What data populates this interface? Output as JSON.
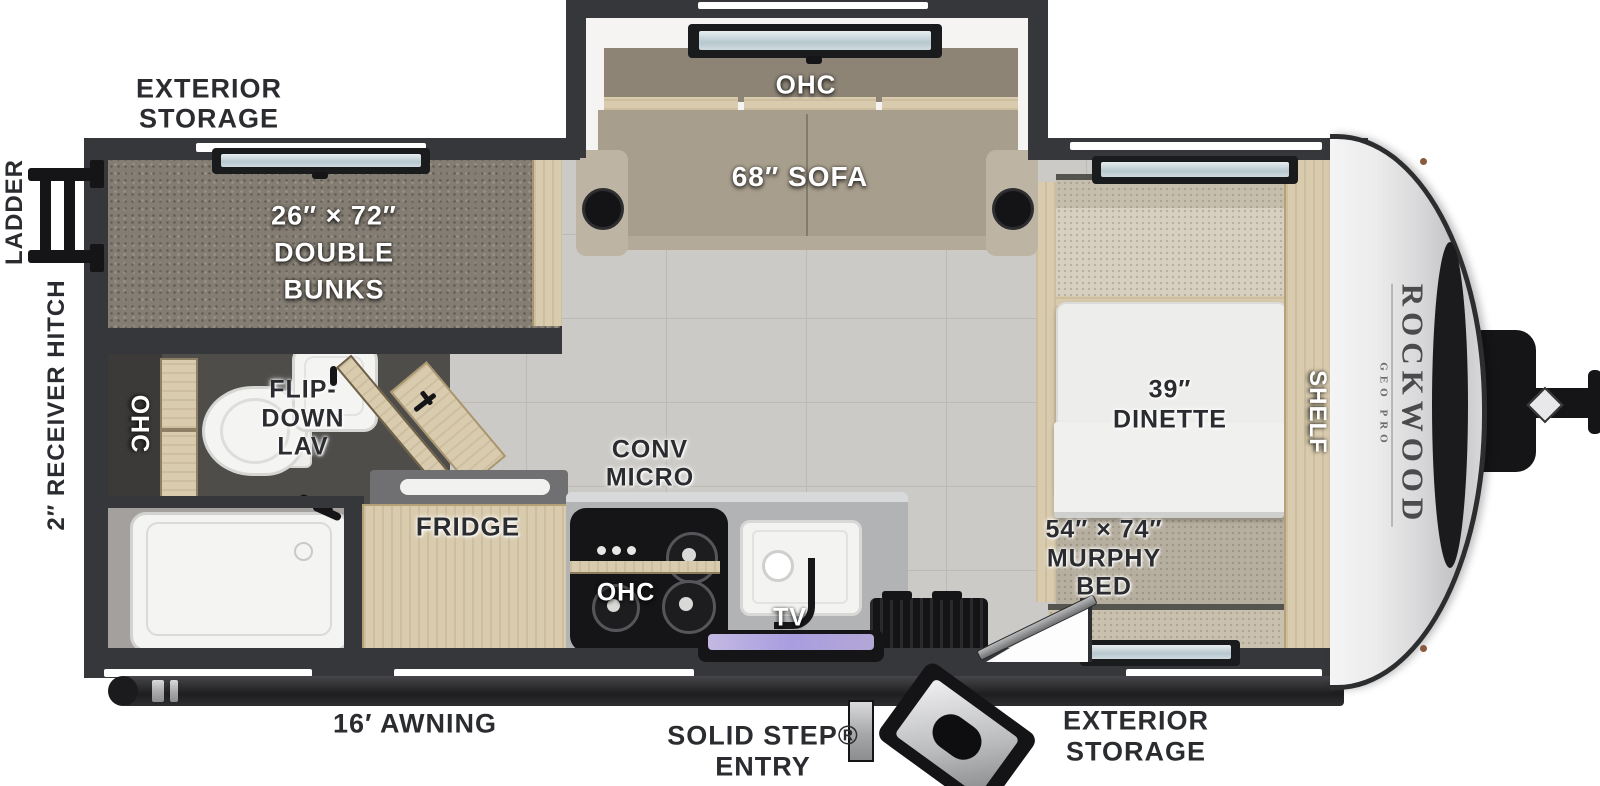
{
  "title": "Rockwood Geo Pro travel trailer floor plan",
  "brand": {
    "name": "ROCKWOOD",
    "sub": "GEO PRO"
  },
  "labels": {
    "exterior_storage_top": [
      "EXTERIOR",
      "STORAGE"
    ],
    "ladder": "LADDER",
    "receiver_hitch": "2″ RECEIVER HITCH",
    "double_bunks": [
      "26″ × 72″",
      "DOUBLE",
      "BUNKS"
    ],
    "ohc_bath": "OHC",
    "flip_down_lav": [
      "FLIP-",
      "DOWN",
      "LAV"
    ],
    "ohc_slide": "OHC",
    "sofa": "68″ SOFA",
    "conv_micro": [
      "CONV",
      "MICRO"
    ],
    "fridge": "FRIDGE",
    "ohc_kitchen": "OHC",
    "tv": "TV",
    "dinette": [
      "39″",
      "DINETTE"
    ],
    "shelf": "SHELF",
    "murphy_bed": [
      "54″ × 74″",
      "MURPHY",
      "BED"
    ],
    "awning": "16′ AWNING",
    "solid_step": [
      "SOLID STEP®",
      "ENTRY"
    ],
    "exterior_storage_bottom": [
      "EXTERIOR",
      "STORAGE"
    ]
  },
  "colors": {
    "wall": "#36373b",
    "floor_tile": "#cccac6",
    "bunk": "#847d73",
    "sofa": "#a89e8d",
    "wood": "#d9cbae",
    "appliance_black": "#151517",
    "fixture_white": "#f3f3f1",
    "stainless": "#b2b3b5",
    "dish_tray": "#b3a7d6",
    "front_cap": "#e9e9eb",
    "label_dark": "#2b2c30",
    "label_white": "#ffffff"
  }
}
